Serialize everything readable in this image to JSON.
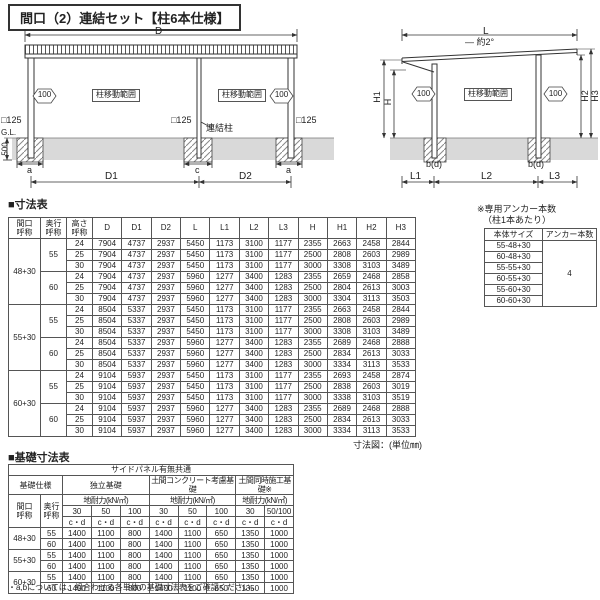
{
  "title": "間口（2）連結セット【柱6本仕様】",
  "front_view": {
    "dim_d": "D",
    "move_range": "柱移動範囲",
    "move_100": "100",
    "post_125": "□125",
    "link_post": "連結柱",
    "gl": "G.L.",
    "depth_500": "500",
    "dim_a": "a",
    "dim_c": "c",
    "dim_d1": "D1",
    "dim_d2": "D2"
  },
  "side_view": {
    "dim_l": "L",
    "slope": "— 約2°",
    "dim_h1": "H1",
    "dim_h": "H",
    "dim_h2": "H2",
    "dim_h3": "H3",
    "move_100": "100",
    "move_range": "柱移動範囲",
    "dim_bd": "b(d)",
    "dim_l1": "L1",
    "dim_l2": "L2",
    "dim_l3": "L3"
  },
  "dim_table": {
    "title": "■寸法表",
    "headers": [
      "間口\n呼称",
      "奥行\n呼称",
      "高さ\n呼称",
      "D",
      "D1",
      "D2",
      "L",
      "L1",
      "L2",
      "L3",
      "H",
      "H1",
      "H2",
      "H3"
    ],
    "rows": [
      [
        {
          "t": "48+30",
          "rs": 6
        },
        {
          "t": "55",
          "rs": 3
        },
        "24",
        "7904",
        "4737",
        "2937",
        "5450",
        "1173",
        "3100",
        "1177",
        "2355",
        "2663",
        "2458",
        "2844"
      ],
      [
        "25",
        "7904",
        "4737",
        "2937",
        "5450",
        "1173",
        "3100",
        "1177",
        "2500",
        "2808",
        "2603",
        "2989"
      ],
      [
        "30",
        "7904",
        "4737",
        "2937",
        "5450",
        "1173",
        "3100",
        "1177",
        "3000",
        "3308",
        "3103",
        "3489"
      ],
      [
        {
          "t": "60",
          "rs": 3
        },
        "24",
        "7904",
        "4737",
        "2937",
        "5960",
        "1277",
        "3400",
        "1283",
        "2355",
        "2659",
        "2468",
        "2858"
      ],
      [
        "25",
        "7904",
        "4737",
        "2937",
        "5960",
        "1277",
        "3400",
        "1283",
        "2500",
        "2804",
        "2613",
        "3003"
      ],
      [
        "30",
        "7904",
        "4737",
        "2937",
        "5960",
        "1277",
        "3400",
        "1283",
        "3000",
        "3304",
        "3113",
        "3503"
      ],
      [
        {
          "t": "55+30",
          "rs": 6
        },
        {
          "t": "55",
          "rs": 3
        },
        "24",
        "8504",
        "5337",
        "2937",
        "5450",
        "1173",
        "3100",
        "1177",
        "2355",
        "2663",
        "2458",
        "2844"
      ],
      [
        "25",
        "8504",
        "5337",
        "2937",
        "5450",
        "1173",
        "3100",
        "1177",
        "2500",
        "2808",
        "2603",
        "2989"
      ],
      [
        "30",
        "8504",
        "5337",
        "2937",
        "5450",
        "1173",
        "3100",
        "1177",
        "3000",
        "3308",
        "3103",
        "3489"
      ],
      [
        {
          "t": "60",
          "rs": 3
        },
        "24",
        "8504",
        "5337",
        "2937",
        "5960",
        "1277",
        "3400",
        "1283",
        "2355",
        "2689",
        "2468",
        "2888"
      ],
      [
        "25",
        "8504",
        "5337",
        "2937",
        "5960",
        "1277",
        "3400",
        "1283",
        "2500",
        "2834",
        "2613",
        "3033"
      ],
      [
        "30",
        "8504",
        "5337",
        "2937",
        "5960",
        "1277",
        "3400",
        "1283",
        "3000",
        "3334",
        "3113",
        "3533"
      ],
      [
        {
          "t": "60+30",
          "rs": 6
        },
        {
          "t": "55",
          "rs": 3
        },
        "24",
        "9104",
        "5937",
        "2937",
        "5450",
        "1173",
        "3100",
        "1177",
        "2355",
        "2693",
        "2458",
        "2874"
      ],
      [
        "25",
        "9104",
        "5937",
        "2937",
        "5450",
        "1173",
        "3100",
        "1177",
        "2500",
        "2838",
        "2603",
        "3019"
      ],
      [
        "30",
        "9104",
        "5937",
        "2937",
        "5450",
        "1173",
        "3100",
        "1177",
        "3000",
        "3338",
        "3103",
        "3519"
      ],
      [
        {
          "t": "60",
          "rs": 3
        },
        "24",
        "9104",
        "5937",
        "2937",
        "5960",
        "1277",
        "3400",
        "1283",
        "2355",
        "2689",
        "2468",
        "2888"
      ],
      [
        "25",
        "9104",
        "5937",
        "2937",
        "5960",
        "1277",
        "3400",
        "1283",
        "2500",
        "2834",
        "2613",
        "3033"
      ],
      [
        "30",
        "9104",
        "5937",
        "2937",
        "5960",
        "1277",
        "3400",
        "1283",
        "3000",
        "3334",
        "3113",
        "3533"
      ]
    ]
  },
  "anchor_table": {
    "note1": "※専用アンカー本数",
    "note2": "（柱1本あたり）",
    "headers": [
      "本体サイズ",
      "アンカー本数"
    ],
    "rows": [
      [
        "55-48+30",
        {
          "t": "4",
          "rs": 6
        }
      ],
      [
        "60-48+30"
      ],
      [
        "55-55+30"
      ],
      [
        "60-55+30"
      ],
      [
        "55-60+30"
      ],
      [
        "60-60+30"
      ]
    ]
  },
  "dim_note": "寸法図：(単位㎜)",
  "foundation_table": {
    "title": "■基礎寸法表",
    "top_header": "サイドパネル有無共通",
    "h_kiso": "基礎仕様",
    "h_dokuritsu": "独立基礎",
    "h_doma": "土間コンクリート考慮基礎",
    "h_domadoji": "土間同時施工基礎※",
    "h_chitai": "地耐力(kN/㎡)",
    "h_maguchi": "間口\n呼称",
    "h_okuyuki": "奥行\n呼称",
    "h_30": "30",
    "h_50": "50",
    "h_100": "100",
    "h_50100": "50/100",
    "h_cd": "c・d",
    "rows": [
      [
        {
          "t": "48+30",
          "rs": 2
        },
        "55",
        "1400",
        "1100",
        "800",
        "1400",
        "1100",
        "650",
        "1350",
        "1000"
      ],
      [
        "60",
        "1400",
        "1100",
        "800",
        "1400",
        "1100",
        "650",
        "1350",
        "1000"
      ],
      [
        {
          "t": "55+30",
          "rs": 2
        },
        "55",
        "1400",
        "1100",
        "800",
        "1400",
        "1100",
        "650",
        "1350",
        "1000"
      ],
      [
        "60",
        "1400",
        "1100",
        "800",
        "1400",
        "1100",
        "650",
        "1350",
        "1000"
      ],
      [
        {
          "t": "60+30",
          "rs": 2
        },
        "55",
        "1400",
        "1100",
        "800",
        "1400",
        "1100",
        "650",
        "1350",
        "1000"
      ],
      [
        "60",
        "1400",
        "1100",
        "800",
        "1400",
        "1100",
        "650",
        "1350",
        "1000"
      ]
    ]
  },
  "footnote": "・a,bについては、組合わせる各単体の基礎寸法表をご確認ください。"
}
